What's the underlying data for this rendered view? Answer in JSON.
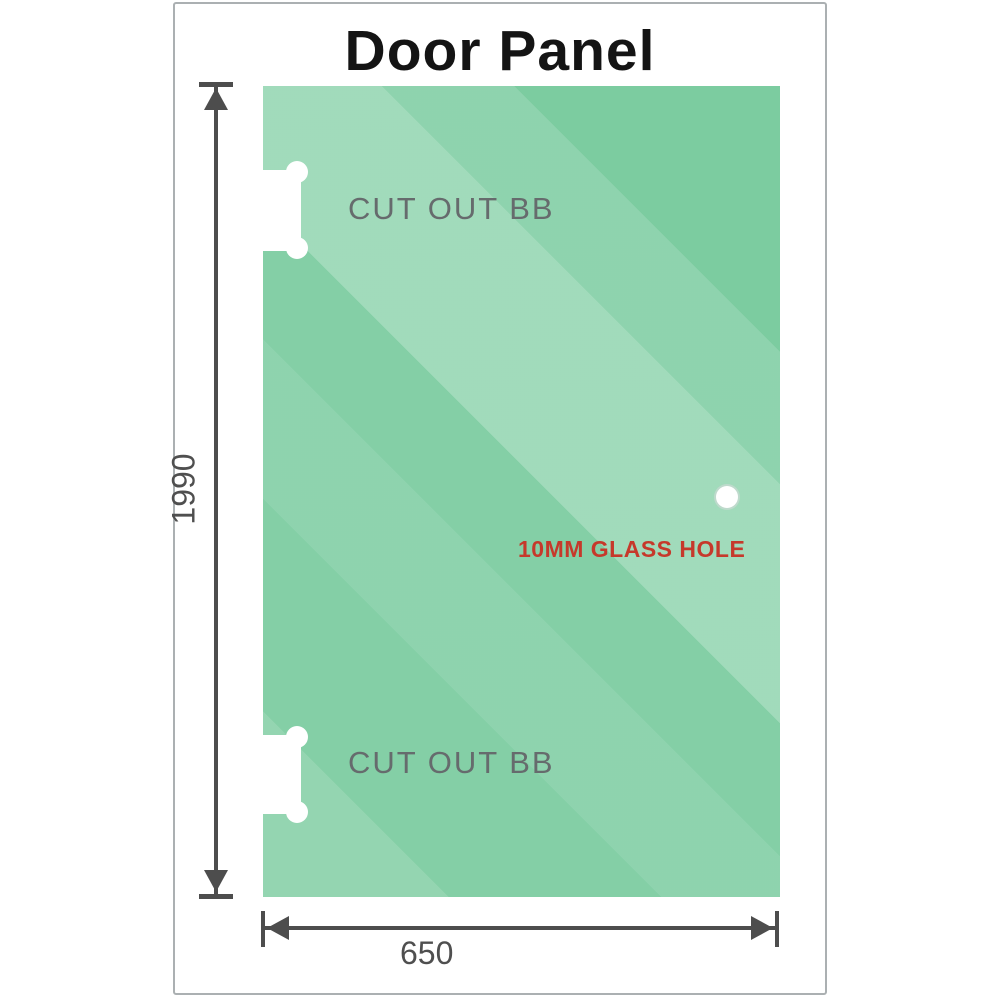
{
  "title": "Door Panel",
  "panel": {
    "cutout_label": "CUT OUT BB",
    "hole_label": "10MM GLASS HOLE"
  },
  "dimensions": {
    "height": "1990",
    "width": "650"
  },
  "colors": {
    "glass_base": "#79cb9e",
    "card_border": "#abb0b2",
    "dim_line": "#4d4d4d",
    "label_gray": "#666b6d",
    "number_gray": "#4f4f4f",
    "hole_label_red": "#c6392b",
    "title_black": "#141414",
    "cutout_white": "#ffffff"
  }
}
